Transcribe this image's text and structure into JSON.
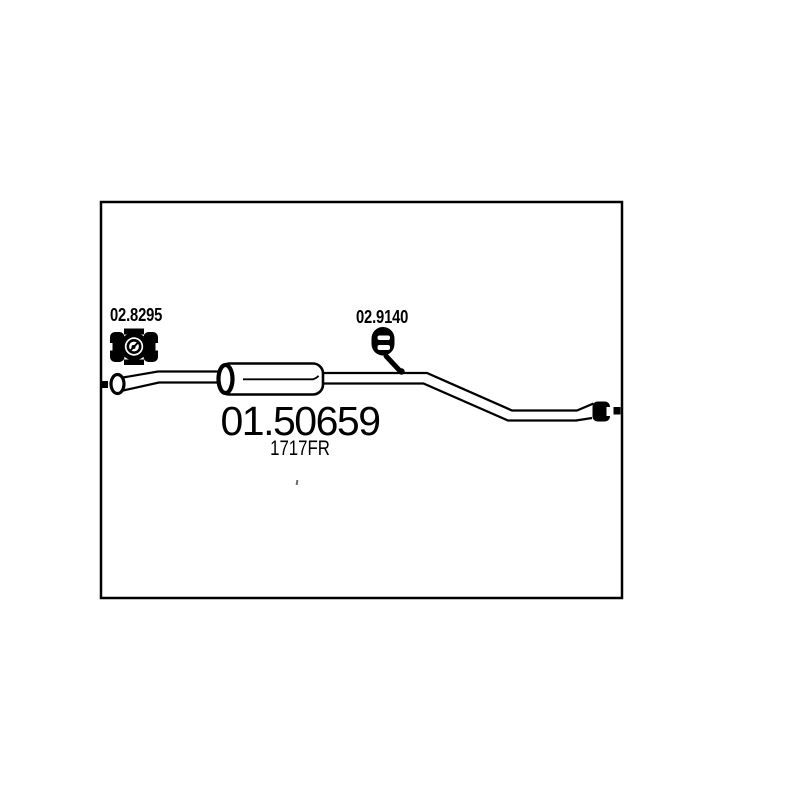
{
  "diagram": {
    "product": {
      "part_number": "01.50659",
      "oe_code": "1717FR",
      "description": "exhaust middle silencer technical line drawing"
    },
    "accessories": [
      {
        "part_number": "02.8295",
        "icon": "exhaust-clamp-icon"
      },
      {
        "part_number": "02.9140",
        "icon": "rubber-hanger-icon"
      }
    ],
    "colors": {
      "line": "#000000",
      "background": "#ffffff"
    }
  }
}
